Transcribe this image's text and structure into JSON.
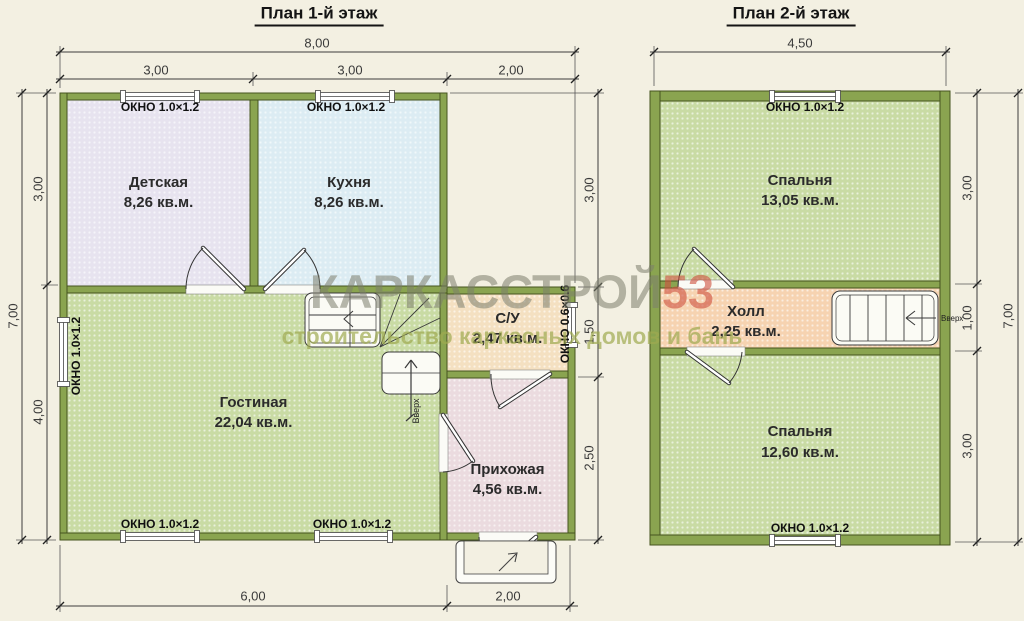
{
  "canvas": {
    "bg": "#f3f0e2"
  },
  "watermark": {
    "brand_main": "КАРКАССТРОЙ",
    "brand_number": "53",
    "tagline": "строительство каркасных домов и бань",
    "colors": {
      "main": "rgba(124,126,108,0.55)",
      "number": "rgba(206,80,62,0.6)",
      "tagline": "rgba(158,170,80,0.7)"
    }
  },
  "labels": {
    "window_1x12": "ОКНО 1.0×1.2",
    "window_06x06": "ОКНО 0.6×0.6",
    "up": "Вверх"
  },
  "floor1": {
    "title": "План 1-й этаж",
    "rooms": {
      "nursery": {
        "name": "Детская",
        "area": "8,26 кв.м.",
        "fill": "#e7e3ef"
      },
      "kitchen": {
        "name": "Кухня",
        "area": "8,26 кв.м.",
        "fill": "#dcecf3"
      },
      "living": {
        "name": "Гостиная",
        "area": "22,04 кв.м.",
        "fill": "#c9dba4"
      },
      "bathroom": {
        "name": "С/У",
        "area": "2,47 кв.м.",
        "fill": "#f4e0c1"
      },
      "hallway": {
        "name": "Прихожая",
        "area": "4,56 кв.м.",
        "fill": "#ebdbdf"
      }
    },
    "dims": {
      "top_total": "8,00",
      "top_segments": [
        "3,00",
        "3,00",
        "2,00"
      ],
      "left_total": "7,00",
      "left_segments": [
        "3,00",
        "4,00"
      ],
      "right_segments": [
        "3,00",
        "1,50",
        "2,50"
      ],
      "bottom_segments": [
        "6,00",
        "2,00"
      ]
    }
  },
  "floor2": {
    "title": "План 2-й этаж",
    "rooms": {
      "bedroom_top": {
        "name": "Спальня",
        "area": "13,05 кв.м.",
        "fill": "#c9dba4"
      },
      "hall": {
        "name": "Холл",
        "area": "2,25 кв.м.",
        "fill": "#f6d3b1"
      },
      "bedroom_bottom": {
        "name": "Спальня",
        "area": "12,60 кв.м.",
        "fill": "#c9dba4"
      }
    },
    "dims": {
      "top_total": "4,50",
      "right_total": "7,00",
      "right_segments": [
        "3,00",
        "1,00",
        "3,00"
      ]
    }
  }
}
